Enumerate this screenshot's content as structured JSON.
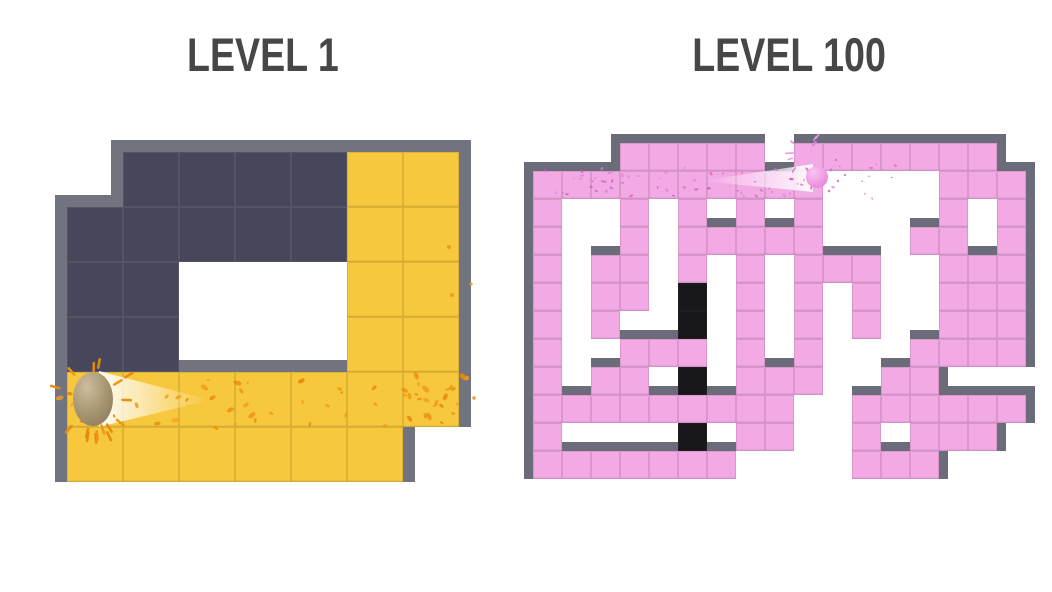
{
  "titles": {
    "left": "LEVEL 1",
    "right": "LEVEL 100",
    "color": "#474747"
  },
  "left_maze": {
    "name": "level-1",
    "origin": [
      67,
      152
    ],
    "tile": [
      56,
      55
    ],
    "wall_color": "#71747F",
    "wall_thick": 12,
    "palette": {
      "D": "#46475A",
      "Y": "#F7C83D"
    },
    "grid": [
      ".DDDDYY",
      "DDDDDYY",
      "DD...YY",
      "DD...YY",
      "YYYYYYY",
      "YYYYYY."
    ],
    "ball": {
      "cx": 93,
      "cy": 399,
      "rx": 20,
      "ry": 27,
      "color_top": "#CDBD9E",
      "color_mid": "#A5936F",
      "color_bottom": "#84735A"
    },
    "trail": {
      "points": "210,400 99,371 99,427",
      "bright_x": 99,
      "fade_x": 210,
      "opacity": 0.95
    },
    "splatters": [
      {
        "seed": 7,
        "count": 46,
        "x": [
          58,
          474
        ],
        "y": [
          377,
          428
        ],
        "r": [
          1.5,
          4.5
        ],
        "colors": [
          "#ED9714",
          "#E68A0E",
          "#F0A01C"
        ]
      },
      {
        "seed": 21,
        "count": 18,
        "x": [
          400,
          476
        ],
        "y": [
          375,
          425
        ],
        "r": [
          1.5,
          4.0
        ],
        "colors": [
          "#ED9714",
          "#E68A0E"
        ]
      }
    ],
    "burst": {
      "seed": 3,
      "cx": 93,
      "cy": 399,
      "count": 16,
      "r1": 26,
      "r2": 44,
      "len": 11,
      "w": 2.6,
      "colors": [
        "#ED9714",
        "#E68A0E"
      ]
    },
    "extra_dots": [
      [
        449,
        247,
        2
      ],
      [
        452,
        295,
        2
      ],
      [
        471,
        284,
        1.6
      ],
      [
        467,
        378,
        2.2
      ],
      [
        474,
        398,
        1.8
      ]
    ],
    "dot_color": "#E89A1A"
  },
  "right_maze": {
    "name": "level-100",
    "origin": [
      533,
      143
    ],
    "tile": [
      29,
      28
    ],
    "wall_color": "#6A6D79",
    "wall_thick": 9,
    "palette": {
      "P": "#F2A9E4",
      "K": "#17171C"
    },
    "grid": [
      "...PPPPP.PPPPPPP.",
      "PPPPPPPPPP....PPP",
      "P..P.P.P.P....P.P",
      "P..P.PPPPP...PP.P",
      "P.PP.P.P.PPP..PPP",
      "P.PP.K.P.P.P..PPP",
      "P.P..K.P.P.P..PPP",
      "P..PPP.P.P...PPPP",
      "P.PP.K.PPP..PP...",
      "PPPPPPPPP..PPPPPP",
      "P....K.PP..P.PPP.",
      "PPPPPPP....PPP..."
    ],
    "ball": {
      "cx": 817,
      "cy": 177,
      "r": 11,
      "color_top": "#FBC4F2",
      "color_mid": "#F09AE3",
      "color_bottom": "#E27BD3"
    },
    "trail": {
      "points": "700,181 813,164 813,192",
      "bright_x": 813,
      "fade_x": 700,
      "opacity": 0.92
    },
    "splatters": [
      {
        "seed": 13,
        "count": 60,
        "x": [
          536,
          812
        ],
        "y": [
          168,
          197
        ],
        "r": [
          0.8,
          2.2
        ],
        "colors": [
          "#D36FC4",
          "#C95FB8",
          "#E089D2"
        ]
      },
      {
        "seed": 31,
        "count": 10,
        "x": [
          820,
          900
        ],
        "y": [
          163,
          200
        ],
        "r": [
          0.8,
          2.0
        ],
        "colors": [
          "#D36FC4",
          "#E089D2"
        ]
      }
    ],
    "burst": {
      "seed": 5,
      "cx": 806,
      "cy": 153,
      "count": 10,
      "r1": 11,
      "r2": 22,
      "len": 6,
      "w": 1.6,
      "colors": [
        "#EF97E0",
        "#E27BD3"
      ]
    },
    "extra_dots": [
      [
        831,
        170,
        1.4
      ],
      [
        838,
        181,
        1.2
      ],
      [
        829,
        191,
        1.3
      ],
      [
        845,
        175,
        1.1
      ],
      [
        836,
        160,
        1.2
      ]
    ],
    "dot_color": "#D36FC4"
  }
}
